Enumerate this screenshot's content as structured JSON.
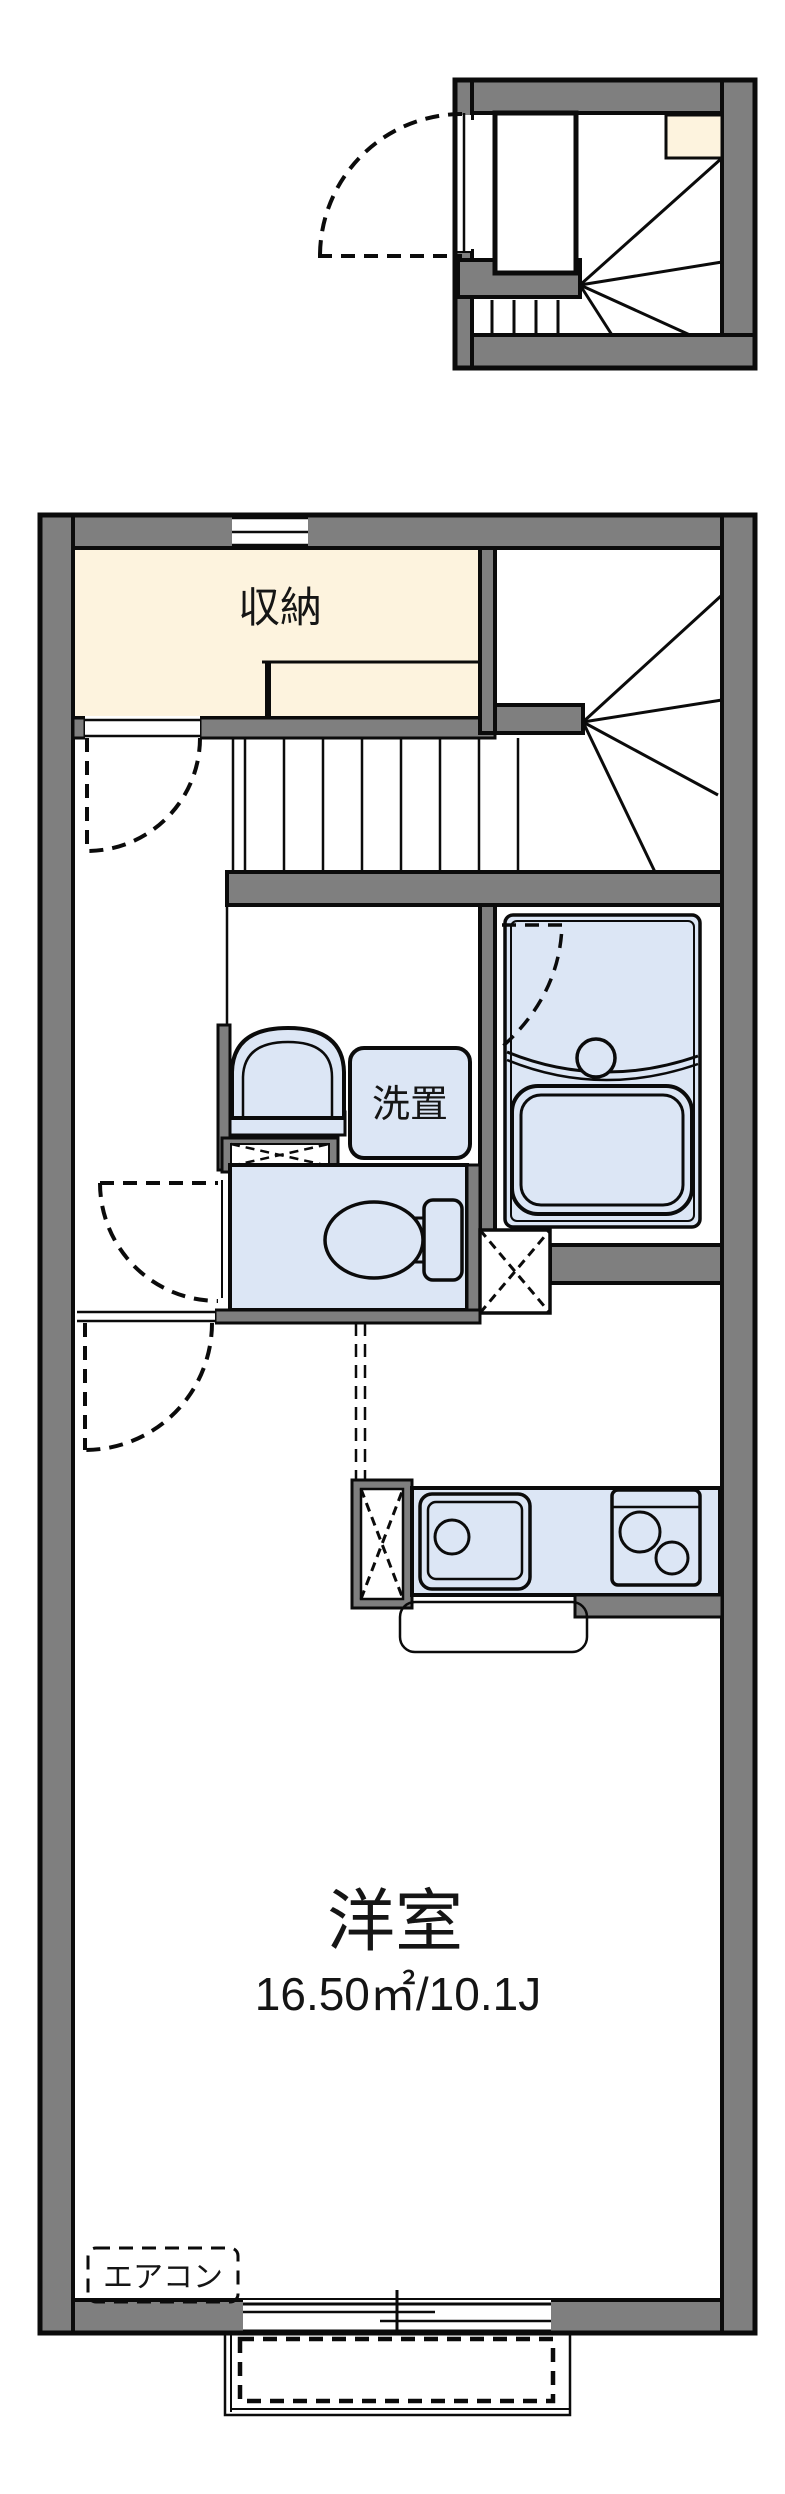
{
  "colors": {
    "wall": "#7f7f7f",
    "outline": "#0b0b0b",
    "closet": "#fdf3de",
    "fixture": "#dce6f5",
    "background": "#ffffff"
  },
  "plan": {
    "storage_label": "収納",
    "laundry_label": "洗置",
    "main_room_label": "洋室",
    "main_room_area": "16.50㎡/10.1J",
    "aircon_label": "エアコン"
  }
}
